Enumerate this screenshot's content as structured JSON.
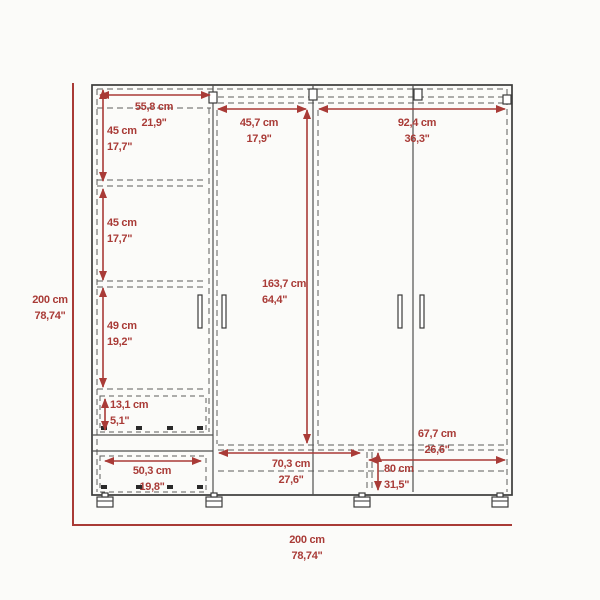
{
  "diagram": {
    "kind": "wardrobe-dimension-drawing",
    "overall_height": {
      "cm": "200 cm",
      "in": "78,74\""
    },
    "overall_width": {
      "cm": "200 cm",
      "in": "78,74\""
    },
    "dimensions": {
      "top_shelf_width": {
        "cm": "55,8 cm",
        "in": "21,9\""
      },
      "upper_shelf_gap": {
        "cm": "45 cm",
        "in": "17,7\""
      },
      "middle_shelf_gap": {
        "cm": "45 cm",
        "in": "17,7\""
      },
      "lower_shelf_gap": {
        "cm": "49 cm",
        "in": "19,2\""
      },
      "drawer_height": {
        "cm": "13,1 cm",
        "in": "5,1\""
      },
      "drawer_width": {
        "cm": "50,3 cm",
        "in": "19,8\""
      },
      "single_door_width": {
        "cm": "45,7 cm",
        "in": "17,9\""
      },
      "double_door_width": {
        "cm": "92,4 cm",
        "in": "36,3\""
      },
      "door_height": {
        "cm": "163,7 cm",
        "in": "64,4\""
      },
      "bottom_shelf_width": {
        "cm": "70,3 cm",
        "in": "27,6\""
      },
      "bottom_right_width": {
        "cm": "67,7 cm",
        "in": "26,6\""
      },
      "bottom_right_height": {
        "cm": "80 cm",
        "in": "31,5\""
      }
    },
    "colors": {
      "dimension_red": "#a93b37",
      "line_dark": "#3b3b3b",
      "line_gray": "#4f4f4f",
      "dash_gray": "#5c5c5c",
      "background": "#fbfbf9"
    }
  }
}
